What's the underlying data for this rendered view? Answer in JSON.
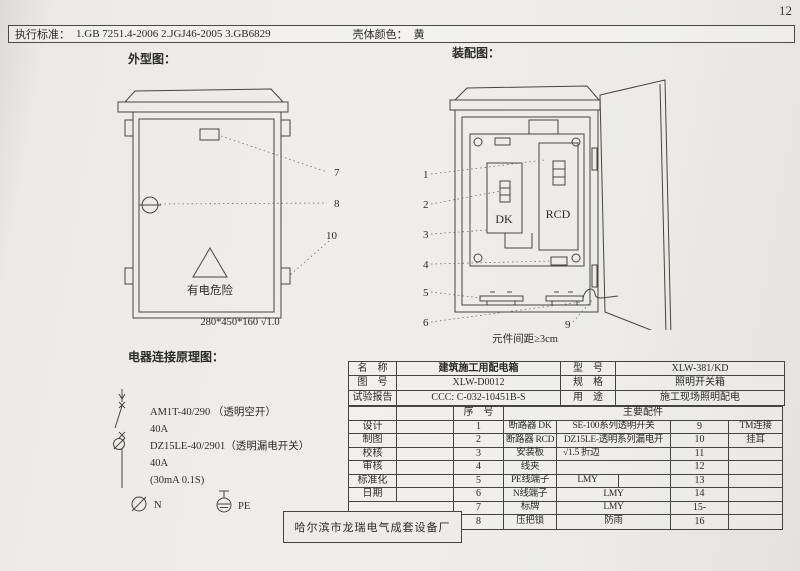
{
  "page": {
    "number": "12"
  },
  "header": {
    "standards_label": "执行标准：",
    "standards": "1.GB 7251.4-2006    2.JGJ46-2005    3.GB6829",
    "shell_color_label": "壳体颜色：",
    "shell_color": "黄"
  },
  "outline": {
    "title": "外型图：",
    "warning_text": "有电危险",
    "dimension": "280*450*160  √1.0",
    "callouts": [
      "7",
      "8",
      "10"
    ]
  },
  "assembly": {
    "title": "装配图：",
    "dk_label": "DK",
    "rcd_label": "RCD",
    "callouts": [
      "1",
      "2",
      "3",
      "4",
      "5",
      "6",
      "9"
    ],
    "note": "元件间距≥3cm"
  },
  "schematic": {
    "title": "电器连接原理图：",
    "lines": [
      "AM1T-40/290 （透明空开）",
      "40A",
      "DZ15LE-40/2901（透明漏电开关）",
      "40A",
      "(30mA 0.1S)"
    ],
    "n_label": "N",
    "pe_label": "PE"
  },
  "manufacturer": "哈尔滨市龙瑞电气成套设备厂",
  "info_table": {
    "rows": [
      {
        "label": "名　称",
        "value": "建筑施工用配电箱",
        "label2": "型　号",
        "value2": "XLW-381/KD"
      },
      {
        "label": "图　号",
        "value": "XLW-D0012",
        "label2": "规　格",
        "value2": "照明开关箱"
      },
      {
        "label": "试验报告",
        "value": "CCC: C-032-10451B-S",
        "label2": "用　途",
        "value2": "施工现场照明配电"
      }
    ]
  },
  "parts_table": {
    "seq_header": "序　号",
    "main_header": "主要配件",
    "sign_labels": [
      "设计",
      "制图",
      "校核",
      "审核",
      "标准化",
      "日期"
    ],
    "rows": [
      {
        "no": "1",
        "name": "断路器 DK",
        "desc": "SE-100系列透明开关",
        "no2": "9",
        "desc2": "TM连接"
      },
      {
        "no": "2",
        "name": "断路器 RCD",
        "desc": "DZ15LE-透明系列漏电开",
        "no2": "10",
        "desc2": "挂耳"
      },
      {
        "no": "3",
        "name": "安装板",
        "desc": "√1.5 折边",
        "no2": "11",
        "desc2": ""
      },
      {
        "no": "4",
        "name": "线夹",
        "desc": "",
        "no2": "12",
        "desc2": ""
      },
      {
        "no": "5",
        "name": "PE线端子",
        "desc": "LMY",
        "no2": "13",
        "desc2": ""
      },
      {
        "no": "6",
        "name": "N线端子",
        "desc": "LMY",
        "no2": "14",
        "desc2": ""
      },
      {
        "no": "7",
        "name": "标牌",
        "desc": "LMY",
        "no2": "15-",
        "desc2": ""
      },
      {
        "no": "8",
        "name": "压把锁",
        "desc": "防雨",
        "no2": "16",
        "desc2": ""
      }
    ]
  }
}
